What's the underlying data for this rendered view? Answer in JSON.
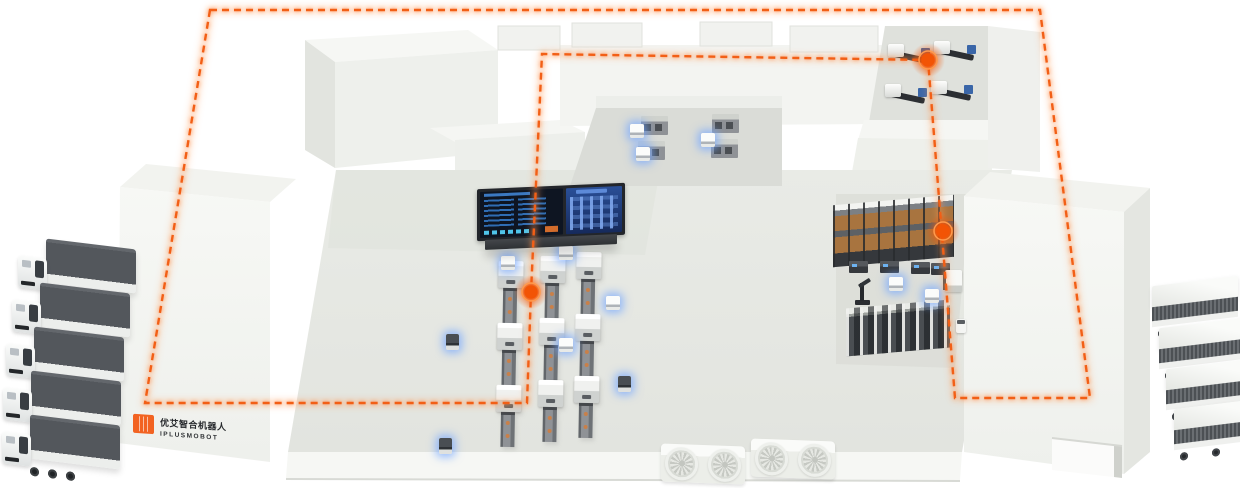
{
  "meta": {
    "scene": "smart-factory-agv-intralogistics-illustration",
    "canvas_width": 1240,
    "canvas_height": 488
  },
  "palette": {
    "accent_orange": "#F25E12",
    "waypoint_core": "#F25405",
    "route_halo": "#FFA46B",
    "agv_glow_blue": "#73A5FF",
    "floor": "#E7E9E4",
    "floor_shade": "#D8DAD4",
    "wall": "#F4F5F2",
    "wall_side": "#E4E6E1",
    "cargo_dark": "#53575C",
    "rack_box_brown": "#A8743F",
    "screen_navy": "#0E1522",
    "screen_blue": "#2F6DB4",
    "screen_cyan": "#4FC4EA"
  },
  "logo": {
    "text_cn": "优艾智合机器人",
    "text_en": "IPLUSMOBOT"
  },
  "route": {
    "style": "dashed",
    "color": "#F25E12",
    "loop_points": [
      [
        210,
        10
      ],
      [
        1040,
        10
      ],
      [
        1090,
        398
      ],
      [
        955,
        398
      ],
      [
        928,
        60
      ],
      [
        542,
        54
      ],
      [
        531,
        292
      ],
      [
        527,
        403
      ],
      [
        145,
        403
      ]
    ],
    "waypoints": [
      {
        "id": "waypoint-production-line",
        "x": 531,
        "y": 292
      },
      {
        "id": "waypoint-storage-rack",
        "x": 943,
        "y": 231
      },
      {
        "id": "waypoint-machining-cell",
        "x": 928,
        "y": 60
      }
    ]
  },
  "fleets": {
    "left_trucks": {
      "count": 5,
      "positions": [
        [
          16,
          244
        ],
        [
          10,
          288
        ],
        [
          4,
          332
        ],
        [
          1,
          376
        ],
        [
          0,
          420
        ]
      ]
    },
    "right_trucks": {
      "count": 4,
      "positions": [
        [
          1152,
          281
        ],
        [
          1159,
          323
        ],
        [
          1166,
          364
        ],
        [
          1174,
          404
        ]
      ]
    }
  },
  "production_lines": {
    "count": 3,
    "units_per_line": 3,
    "columns": [
      [
        497,
        261
      ],
      [
        539,
        256
      ],
      [
        575,
        252
      ]
    ]
  },
  "floor_agvs": {
    "white": [
      [
        501,
        256
      ],
      [
        559,
        246
      ],
      [
        606,
        296
      ],
      [
        559,
        338
      ]
    ],
    "dark": [
      [
        446,
        334
      ],
      [
        439,
        438
      ],
      [
        618,
        376
      ]
    ]
  },
  "cabinet_room": {
    "cabinets": [
      [
        641,
        116
      ],
      [
        712,
        114
      ],
      [
        638,
        141
      ],
      [
        711,
        139
      ]
    ],
    "agvs": [
      [
        630,
        124
      ],
      [
        636,
        147
      ],
      [
        701,
        133
      ]
    ]
  },
  "machining_cell": {
    "machines": [
      [
        888,
        44
      ],
      [
        934,
        41
      ],
      [
        885,
        84
      ],
      [
        931,
        81
      ]
    ]
  },
  "storage_zone": {
    "rack_top": {
      "x": 833,
      "y": 200,
      "w": 121,
      "h": 62
    },
    "rack_bottom": {
      "x": 846,
      "y": 304,
      "w": 104,
      "h": 48
    },
    "dock_bots": [
      [
        849,
        261
      ],
      [
        880,
        261
      ],
      [
        911,
        262
      ],
      [
        931,
        263
      ]
    ],
    "white_agvs": [
      [
        889,
        277
      ],
      [
        925,
        289
      ]
    ],
    "arm_robot": [
      855,
      279
    ],
    "forklift": [
      945,
      270
    ],
    "small_bot": [
      956,
      319
    ]
  },
  "hvac": {
    "groups": [
      [
        661,
        445
      ],
      [
        751,
        440
      ]
    ],
    "fans_per_group": 2
  },
  "dashboard": {
    "panels": [
      "production-data-table",
      "line-status-schematic"
    ]
  }
}
